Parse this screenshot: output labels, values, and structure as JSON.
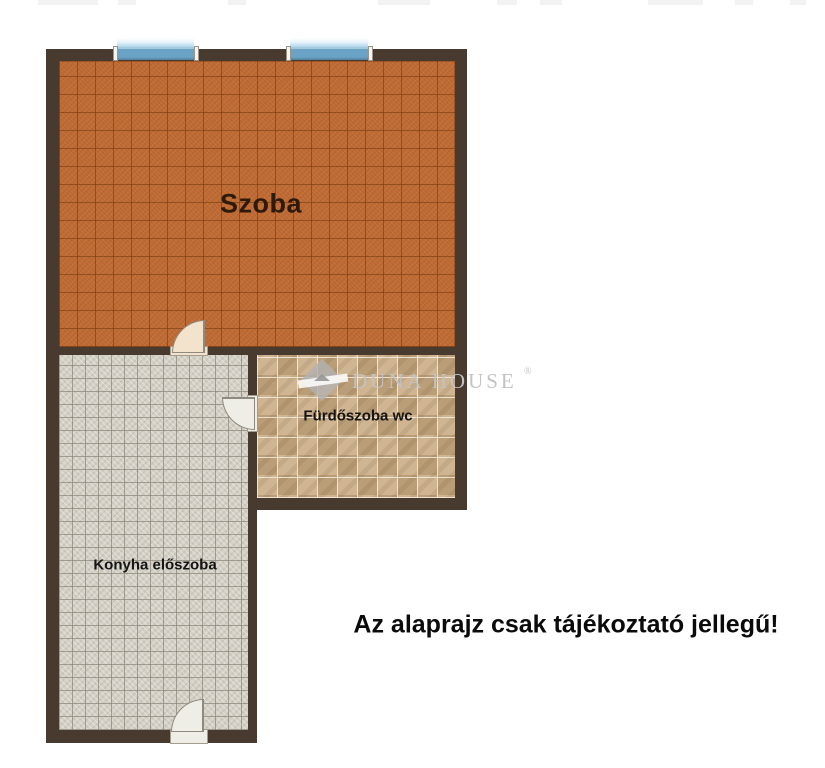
{
  "meta": {
    "kind": "real-estate floor plan",
    "language": "hu"
  },
  "colors": {
    "wall": "#483A2F",
    "szoba_floor": "#BF6B33",
    "konyha_floor": "#D5D1C7",
    "furdo_floor": "#C9AD86",
    "window_glass": "#6BA3C6",
    "door_szoba": "#F3E2CC",
    "door_white": "#EFEEE6",
    "watermark": "#C3C3C3"
  },
  "rooms": [
    {
      "name": "szoba",
      "label": "Szoba"
    },
    {
      "name": "furdoszoba-wc",
      "label": "Fürdőszoba wc"
    },
    {
      "name": "konyha-eloszoba",
      "label": "Konyha előszoba"
    }
  ],
  "features": {
    "window_count": 2,
    "door_count": 3
  },
  "watermark": {
    "text": "DUNA HOUSE",
    "registered": "®"
  },
  "disclaimer": {
    "text": "Az alaprajz csak tájékoztató jellegű!"
  }
}
